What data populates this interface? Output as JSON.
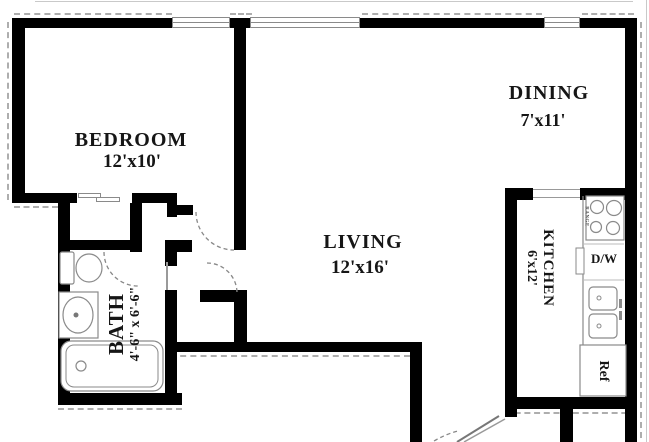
{
  "rooms": {
    "bedroom": {
      "name": "BEDROOM",
      "dims": "12'x10'"
    },
    "dining": {
      "name": "DINING",
      "dims": "7'x11'"
    },
    "living": {
      "name": "LIVING",
      "dims": "12'x16'"
    },
    "kitchen": {
      "name": "KITCHEN",
      "dims": "6'x12'"
    },
    "bath": {
      "name": "BATH",
      "dims": "4'-6\" x 6'-6\""
    }
  },
  "labels": {
    "dishwasher": "D/W",
    "refrigerator": "Ref",
    "range": "RANGE"
  },
  "colors": {
    "wall": "#000000",
    "fixture_line": "#8a8a8a",
    "door_arc": "#888888",
    "hatch": "#aeaeae",
    "text": "#161616",
    "background": "#ffffff"
  }
}
